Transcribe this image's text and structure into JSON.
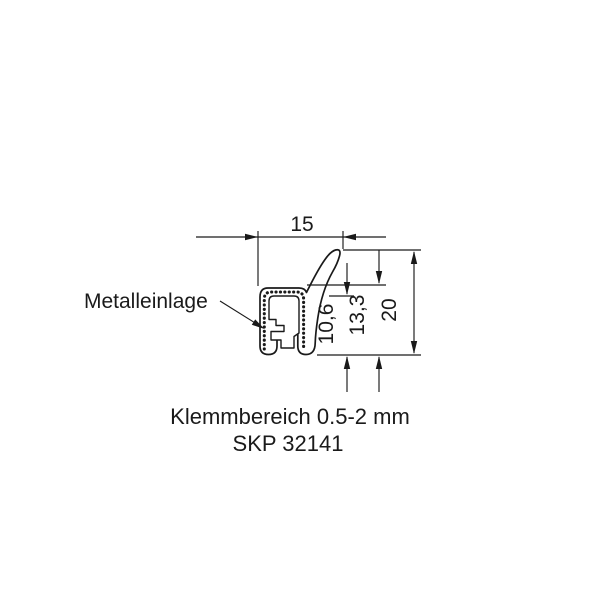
{
  "drawing": {
    "metal_insert_label": "Metalleinlage",
    "dimensions": {
      "width": "15",
      "inner_height": "10,6",
      "body_height": "13,3",
      "total_height": "20"
    },
    "caption": {
      "clamping_range": "Klemmbereich 0.5-2 mm",
      "part_number": "SKP 32141"
    },
    "colors": {
      "line": "#1a1a1a",
      "background": "#ffffff"
    }
  }
}
